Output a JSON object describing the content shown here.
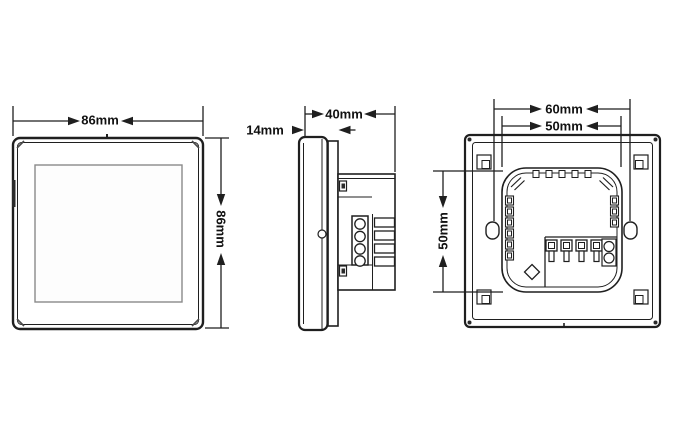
{
  "views": {
    "front": {
      "width": "86mm",
      "height": "86mm"
    },
    "side": {
      "panel_thickness": "14mm",
      "total_depth": "40mm"
    },
    "back": {
      "mounting_hole_spacing": "60mm",
      "body_width": "50mm",
      "body_height": "50mm"
    }
  },
  "colors": {
    "background": "#ffffff",
    "line": "#1f1f1f",
    "screen_outline": "#8a8a8a"
  }
}
